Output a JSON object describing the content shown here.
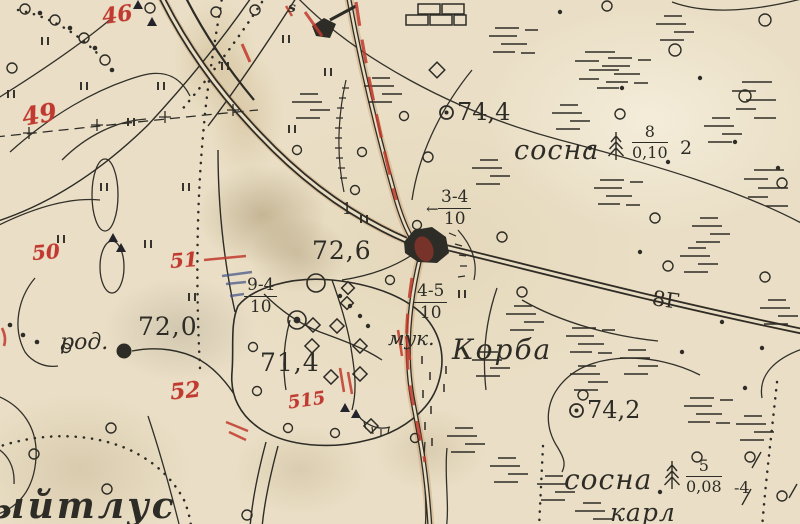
{
  "map": {
    "type": "scanned historical topographic map",
    "language": "ru",
    "colors": {
      "paper": "#eadfc6",
      "ink": "#2e2c26",
      "red_overprint": "#c13a31",
      "blue_pencil": "#3d4e85",
      "road_fill": "#c9a070"
    },
    "icons": {
      "spot_height": "circled-dot",
      "pine_tree": "fir-tree",
      "ruin": "brick-wall",
      "spring": "filled-dot"
    },
    "labels": {
      "spot_height_744": "74,4",
      "spot_height_742": "74,2",
      "elevation_726": "72,6",
      "elevation_720": "72,0",
      "elevation_714": "71,4",
      "spring_abbr": "род.",
      "mill_abbr": "мук.",
      "village_name": "Корба",
      "pine_label_top": "сосна",
      "pine_label_bottom": "сосна",
      "dwarf_abbr": "карл",
      "place_name_partial": "ыйтлус",
      "road_width_mark": "8Г",
      "small_digit_1": "1",
      "small_letter_s": "s",
      "arrow_left": "←"
    },
    "fractions": {
      "forest_top": {
        "num": "8",
        "den": "0,10",
        "side": "2"
      },
      "forest_bottom": {
        "num": "5",
        "den": "0,08",
        "side": "-4"
      },
      "road_34": {
        "num": "3-4",
        "den": "10"
      },
      "road_94": {
        "num": "9-4",
        "den": "10"
      },
      "road_45": {
        "num": "4-5",
        "den": "10"
      }
    },
    "red_annotations": {
      "n46": "46",
      "n49": "49",
      "n50": "50",
      "n51": "51",
      "n52": "52",
      "n515": "515"
    }
  }
}
